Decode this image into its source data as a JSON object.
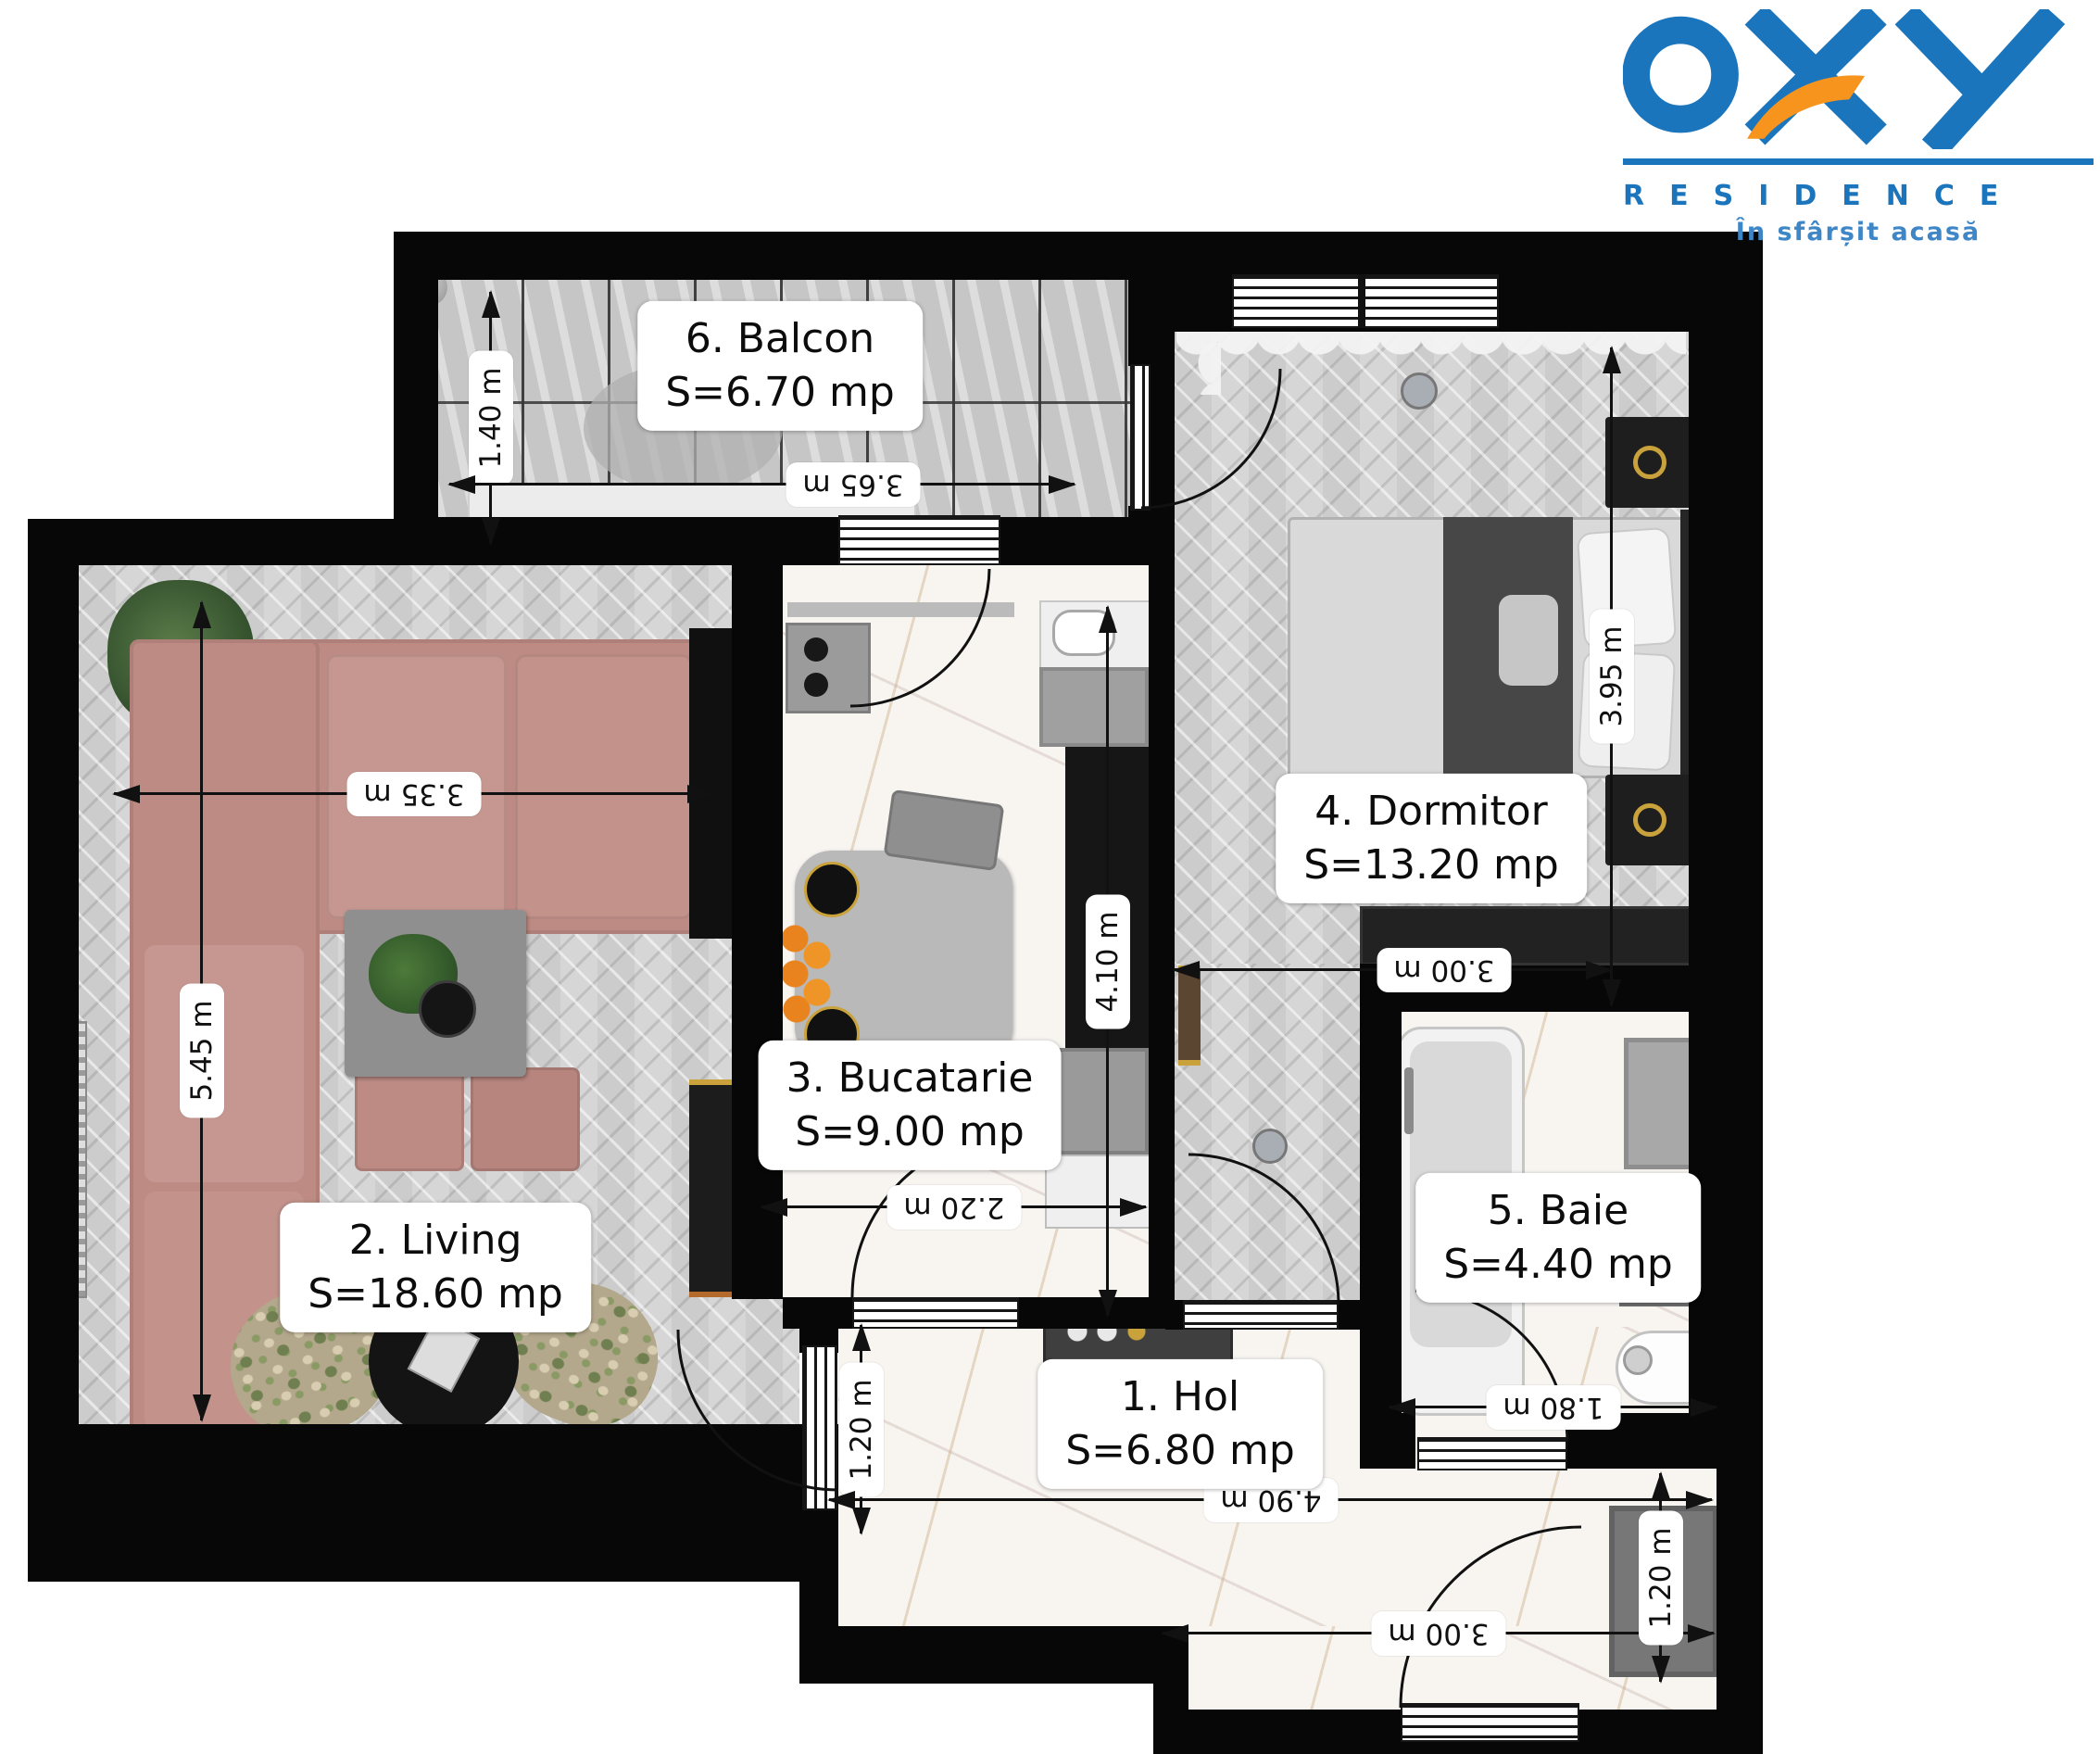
{
  "brand": {
    "name": "OXY",
    "residence": "RESIDENCE",
    "tagline": "În sfârșit acasă",
    "blue": "#1b75bc",
    "orange": "#f7941d"
  },
  "rooms": [
    {
      "id": "hol",
      "label": "1. Hol",
      "area": "S=6.80 mp"
    },
    {
      "id": "living",
      "label": "2. Living",
      "area": "S=18.60 mp"
    },
    {
      "id": "bucatarie",
      "label": "3. Bucatarie",
      "area": "S=9.00 mp"
    },
    {
      "id": "dormitor",
      "label": "4. Dormitor",
      "area": "S=13.20 mp"
    },
    {
      "id": "baie",
      "label": "5. Baie",
      "area": "S=4.40 mp"
    },
    {
      "id": "balcon",
      "label": "6. Balcon",
      "area": "S=6.70 mp"
    }
  ],
  "dims": {
    "balcon_depth": "1.40 m",
    "balcon_width": "3.65 m",
    "living_width": "3.35 m",
    "living_depth": "5.45 m",
    "bucatarie_depth": "4.10 m",
    "bucatarie_width": "2.20 m",
    "dormitor_depth": "3.95 m",
    "dormitor_width": "3.00 m",
    "baie_width": "1.80 m",
    "hol_entry_depth": "1.20 m",
    "hol_width": "4.90 m",
    "entrance_width": "3.00 m",
    "entrance_depth": "1.20 m"
  }
}
